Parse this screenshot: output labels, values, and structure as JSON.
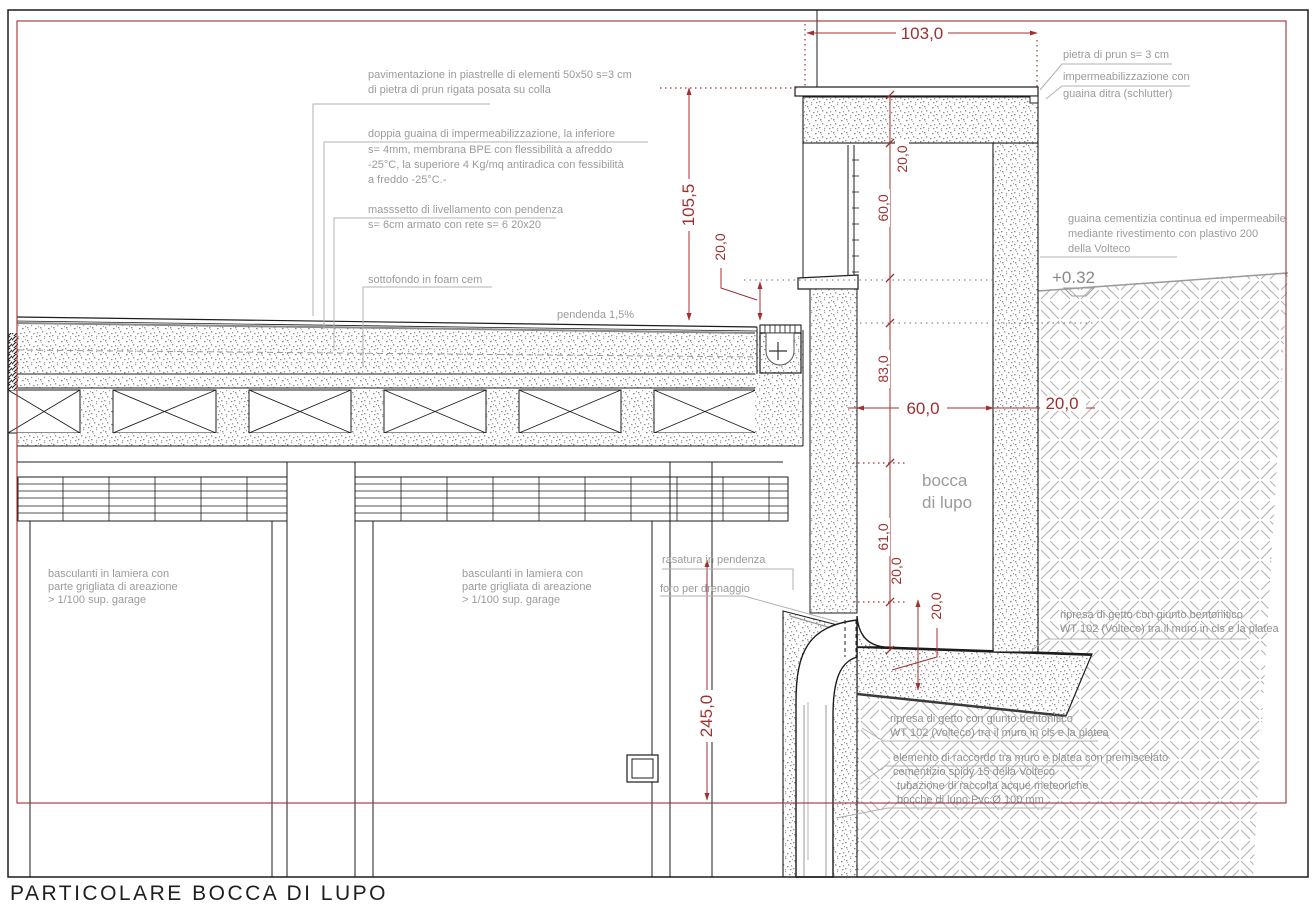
{
  "title": "PARTICOLARE  BOCCA DI LUPO",
  "colors": {
    "dim_red": "#a03030",
    "frame_red": "#993333",
    "annotation_gray": "#9b9b9b",
    "line_black": "#1c1c1c"
  },
  "notes": {
    "pav1": "pavimentazione in piastrelle di elementi 50x50 s=3 cm",
    "pav2": "di pietra di prun rigata posata su colla",
    "gua1": "doppia guaina di impermeabilizzazione, la inferiore",
    "gua2": "s= 4mm, membrana BPE con flessibilità a afreddo",
    "gua3": " -25°C, la superiore 4 Kg/mq antiradica con fessibilità",
    "gua4": "a freddo -25°C.-",
    "mas1": "masssetto di livellamento con pendenza",
    "mas2": "s= 6cm armato con rete s= 6 20x20",
    "sot": "sottofondo in foam cem",
    "pend": "pendenda 1,5%",
    "pietra": "pietra di prun s= 3 cm",
    "imp1": "impermeabilizzazione con",
    "imp2": "guaina ditra (schlutter)",
    "gc1": "guaina cementizia continua ed impermeabile",
    "gc2": "mediante rivestimento con  plastivo 200",
    "gc3": "della Volteco",
    "ras": "rasatura in pendenza",
    "foro": "foro per drenaggio",
    "bas1": "basculanti in lamiera con",
    "bas2": "parte grigliata di areazione",
    "bas3": "> 1/100 sup. garage",
    "rip1": "ripresa di getto con giunto bentonitico",
    "rip2": "WT 102 (Volteco) tra il muro in cls e la platea",
    "ele1": "elemento di raccordo tra muro e platea con premiscelato",
    "ele2": "cementizio spidy 15 della Volteco",
    "tub1": "tubazione di raccolta acque meteoriche",
    "tub2": "bocche di lupo Pvc Ø 100 mm"
  },
  "labels": {
    "quota": "+0.32",
    "bocca1": "bocca",
    "bocca2": "di lupo"
  },
  "dims": {
    "d103": "103,0",
    "d105_5": "105,5",
    "d20": "20,0",
    "d60": "60,0",
    "d83": "83,0",
    "d61": "61,0",
    "d245": "245,0"
  }
}
